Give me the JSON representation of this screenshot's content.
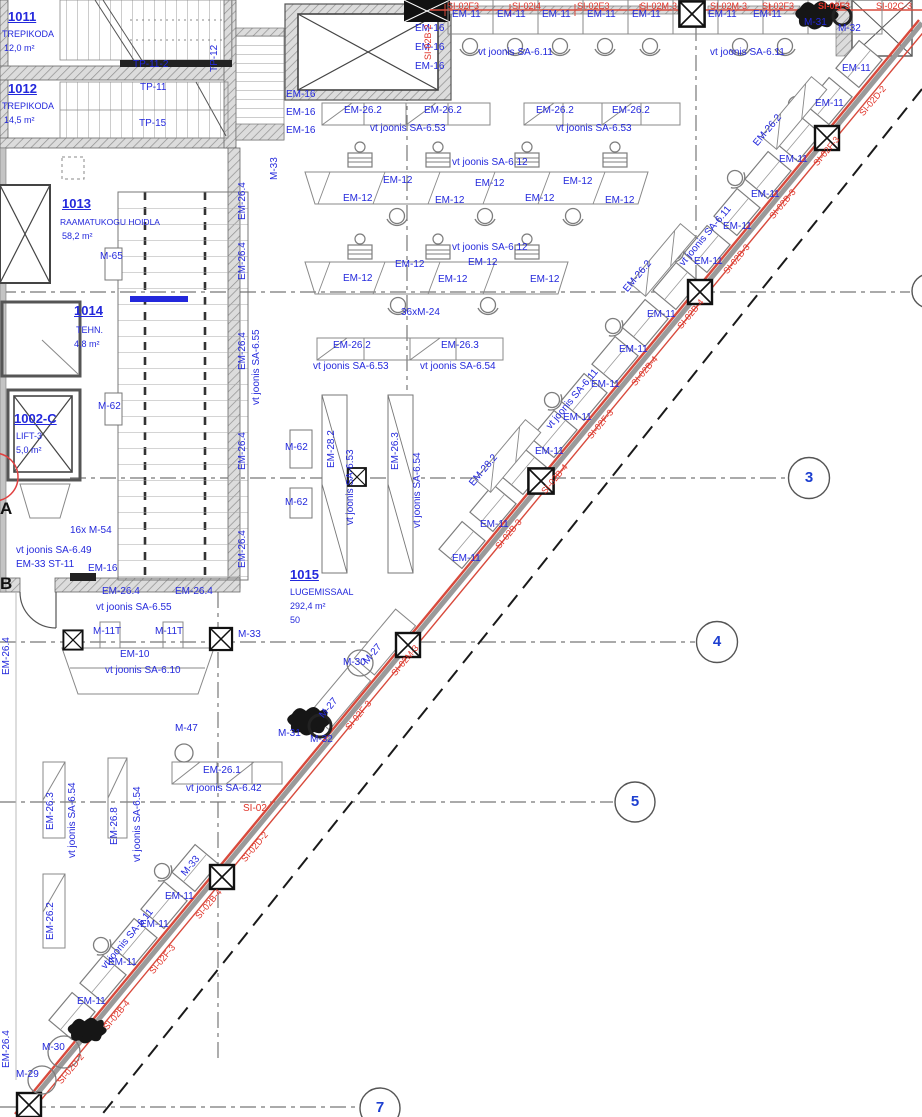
{
  "plan": {
    "colors": {
      "label_blue": "#2328dc",
      "label_red": "#e03328",
      "label_black": "#111111",
      "wall_red_line": "#d84a3c",
      "grid_gray": "#777777"
    },
    "grid_markers": [
      {
        "n": "3",
        "x": 809,
        "y": 478
      },
      {
        "n": "4",
        "x": 717,
        "y": 642
      },
      {
        "n": "5",
        "x": 635,
        "y": 802
      },
      {
        "n": "7",
        "x": 380,
        "y": 1108
      }
    ],
    "labels": [
      {
        "t": "1011",
        "x": 8,
        "y": 10,
        "s": 13,
        "b": 1,
        "u": 1
      },
      {
        "t": "TREPIKODA",
        "x": 2,
        "y": 30,
        "s": 9
      },
      {
        "t": "12,0 m²",
        "x": 4,
        "y": 44,
        "s": 9
      },
      {
        "t": "1012",
        "x": 8,
        "y": 82,
        "s": 13,
        "b": 1,
        "u": 1
      },
      {
        "t": "TREPIKODA",
        "x": 2,
        "y": 102,
        "s": 9
      },
      {
        "t": "14,5 m²",
        "x": 4,
        "y": 116,
        "s": 9
      },
      {
        "t": "1013",
        "x": 62,
        "y": 197,
        "s": 13,
        "b": 1,
        "u": 1
      },
      {
        "t": "RAAMATUKOGU HOIDLA",
        "x": 60,
        "y": 218,
        "s": 8.5
      },
      {
        "t": "58,2 m²",
        "x": 62,
        "y": 232,
        "s": 9
      },
      {
        "t": "1014",
        "x": 74,
        "y": 304,
        "s": 13,
        "b": 1,
        "u": 1
      },
      {
        "t": "TEHN.",
        "x": 76,
        "y": 326,
        "s": 9
      },
      {
        "t": "4,8 m²",
        "x": 74,
        "y": 340,
        "s": 9
      },
      {
        "t": "1002-C",
        "x": 14,
        "y": 412,
        "s": 13,
        "b": 1,
        "u": 1
      },
      {
        "t": "LIFT-3",
        "x": 16,
        "y": 432,
        "s": 9
      },
      {
        "t": "5,0 m²",
        "x": 16,
        "y": 446,
        "s": 9
      },
      {
        "t": "1015",
        "x": 290,
        "y": 568,
        "s": 13,
        "b": 1,
        "u": 1
      },
      {
        "t": "LUGEMISSAAL",
        "x": 290,
        "y": 588,
        "s": 9
      },
      {
        "t": "292,4 m²",
        "x": 290,
        "y": 602,
        "s": 9
      },
      {
        "t": "50",
        "x": 290,
        "y": 616,
        "s": 9
      },
      {
        "t": "TP-11-2",
        "x": 133,
        "y": 60
      },
      {
        "t": "TP-11",
        "x": 140,
        "y": 83
      },
      {
        "t": "TP-15",
        "x": 139,
        "y": 119
      },
      {
        "t": "TP-12",
        "x": 210,
        "y": 72,
        "r": -90
      },
      {
        "t": "M-33",
        "x": 270,
        "y": 180,
        "r": -90
      },
      {
        "t": "A",
        "x": 0,
        "y": 500,
        "c": "k",
        "s": 17,
        "b": 1
      },
      {
        "t": "B",
        "x": 0,
        "y": 575,
        "c": "k",
        "s": 17,
        "b": 1
      },
      {
        "t": "EM-16",
        "x": 415,
        "y": 24
      },
      {
        "t": "EM-16",
        "x": 415,
        "y": 43
      },
      {
        "t": "EM-16",
        "x": 415,
        "y": 62
      },
      {
        "t": "EM-16",
        "x": 286,
        "y": 90
      },
      {
        "t": "EM-16",
        "x": 286,
        "y": 108
      },
      {
        "t": "EM-16",
        "x": 286,
        "y": 126
      },
      {
        "t": "EM-11",
        "x": 452,
        "y": 10
      },
      {
        "t": "EM-11",
        "x": 497,
        "y": 10
      },
      {
        "t": "EM-11",
        "x": 542,
        "y": 10
      },
      {
        "t": "EM-11",
        "x": 587,
        "y": 10
      },
      {
        "t": "EM-11",
        "x": 632,
        "y": 10
      },
      {
        "t": "EM-11",
        "x": 708,
        "y": 10
      },
      {
        "t": "EM-11",
        "x": 753,
        "y": 10
      },
      {
        "t": "vt joonis SA-6.11",
        "x": 478,
        "y": 48
      },
      {
        "t": "vt joonis SA-6.11",
        "x": 710,
        "y": 48
      },
      {
        "t": "M-31",
        "x": 804,
        "y": 18
      },
      {
        "t": "M-32",
        "x": 838,
        "y": 24
      },
      {
        "t": "SI-02F3",
        "x": 447,
        "y": 2,
        "c": "r",
        "s": 9
      },
      {
        "t": "SI-02I4",
        "x": 512,
        "y": 2,
        "c": "r",
        "s": 9
      },
      {
        "t": "SI-02E3",
        "x": 577,
        "y": 2,
        "c": "r",
        "s": 9
      },
      {
        "t": "SI-02M-3",
        "x": 640,
        "y": 2,
        "c": "r",
        "s": 9
      },
      {
        "t": "SI-02M-3",
        "x": 710,
        "y": 2,
        "c": "r",
        "s": 9
      },
      {
        "t": "SI-02F3",
        "x": 762,
        "y": 2,
        "c": "r",
        "s": 9
      },
      {
        "t": "SI-02F3",
        "x": 818,
        "y": 2,
        "c": "r",
        "s": 9,
        "b": 1
      },
      {
        "t": "SI-02C-3",
        "x": 876,
        "y": 2,
        "c": "r",
        "s": 9
      },
      {
        "t": "SI-02B-2",
        "x": 424,
        "y": 60,
        "r": -90,
        "c": "r",
        "s": 9
      },
      {
        "t": "EM-26.2",
        "x": 344,
        "y": 106
      },
      {
        "t": "EM-26.2",
        "x": 424,
        "y": 106
      },
      {
        "t": "EM-26.2",
        "x": 536,
        "y": 106
      },
      {
        "t": "EM-26.2",
        "x": 612,
        "y": 106
      },
      {
        "t": "vt joonis SA-6.53",
        "x": 370,
        "y": 124
      },
      {
        "t": "vt joonis SA-6.53",
        "x": 556,
        "y": 124
      },
      {
        "t": "vt joonis SA-6.12",
        "x": 452,
        "y": 158
      },
      {
        "t": "EM-12",
        "x": 383,
        "y": 176
      },
      {
        "t": "EM-12",
        "x": 343,
        "y": 194
      },
      {
        "t": "EM-12",
        "x": 435,
        "y": 196
      },
      {
        "t": "EM-12",
        "x": 475,
        "y": 179
      },
      {
        "t": "EM-12",
        "x": 525,
        "y": 194
      },
      {
        "t": "EM-12",
        "x": 563,
        "y": 177
      },
      {
        "t": "EM-12",
        "x": 605,
        "y": 196
      },
      {
        "t": "vt joonis SA-6.12",
        "x": 452,
        "y": 243
      },
      {
        "t": "EM-12",
        "x": 395,
        "y": 260
      },
      {
        "t": "EM-12",
        "x": 343,
        "y": 274
      },
      {
        "t": "EM-12",
        "x": 438,
        "y": 275
      },
      {
        "t": "EM-12",
        "x": 468,
        "y": 258
      },
      {
        "t": "EM-12",
        "x": 530,
        "y": 275
      },
      {
        "t": "36xM-24",
        "x": 401,
        "y": 308
      },
      {
        "t": "EM-26.2",
        "x": 333,
        "y": 341
      },
      {
        "t": "EM-26.3",
        "x": 441,
        "y": 341
      },
      {
        "t": "vt joonis SA-6.53",
        "x": 313,
        "y": 362
      },
      {
        "t": "vt joonis SA-6.54",
        "x": 420,
        "y": 362
      },
      {
        "t": "M-65",
        "x": 100,
        "y": 252
      },
      {
        "t": "M-62",
        "x": 98,
        "y": 402
      },
      {
        "t": "M-62",
        "x": 285,
        "y": 443
      },
      {
        "t": "M-62",
        "x": 285,
        "y": 498
      },
      {
        "t": "EM-28.2",
        "x": 327,
        "y": 468,
        "r": -90
      },
      {
        "t": "vt joonis SA-6.53",
        "x": 346,
        "y": 525,
        "r": -90
      },
      {
        "t": "EM-26.3",
        "x": 391,
        "y": 470,
        "r": -90
      },
      {
        "t": "vt joonis SA-6.54",
        "x": 413,
        "y": 528,
        "r": -90
      },
      {
        "t": "EM-26.4",
        "x": 238,
        "y": 220,
        "r": -90
      },
      {
        "t": "EM-26.4",
        "x": 238,
        "y": 280,
        "r": -90
      },
      {
        "t": "EM-26.4",
        "x": 238,
        "y": 370,
        "r": -90
      },
      {
        "t": "EM-26.4",
        "x": 238,
        "y": 470,
        "r": -90
      },
      {
        "t": "EM-26.4",
        "x": 238,
        "y": 568,
        "r": -90
      },
      {
        "t": "vt joonis SA-6.55",
        "x": 252,
        "y": 405,
        "r": -90
      },
      {
        "t": "16x M-54",
        "x": 70,
        "y": 526
      },
      {
        "t": "vt joonis SA-6.49",
        "x": 16,
        "y": 546
      },
      {
        "t": "EM-33 ST-11",
        "x": 16,
        "y": 560
      },
      {
        "t": "EM-16",
        "x": 88,
        "y": 564
      },
      {
        "t": "EM-26.4",
        "x": 102,
        "y": 587
      },
      {
        "t": "EM-26.4",
        "x": 175,
        "y": 587
      },
      {
        "t": "vt joonis SA-6.55",
        "x": 96,
        "y": 603
      },
      {
        "t": "M-11T",
        "x": 93,
        "y": 627
      },
      {
        "t": "M-11T",
        "x": 155,
        "y": 627
      },
      {
        "t": "M-33",
        "x": 238,
        "y": 630
      },
      {
        "t": "EM-10",
        "x": 120,
        "y": 650
      },
      {
        "t": "vt joonis SA-6.10",
        "x": 105,
        "y": 666
      },
      {
        "t": "M-27",
        "x": 362,
        "y": 660,
        "r": -50
      },
      {
        "t": "M-27",
        "x": 318,
        "y": 714,
        "r": -50
      },
      {
        "t": "M-30",
        "x": 343,
        "y": 658
      },
      {
        "t": "M-31",
        "x": 278,
        "y": 729
      },
      {
        "t": "M-32",
        "x": 310,
        "y": 735
      },
      {
        "t": "M-47",
        "x": 175,
        "y": 724
      },
      {
        "t": "EM-26.1",
        "x": 203,
        "y": 766
      },
      {
        "t": "vt joonis SA-6.42",
        "x": 186,
        "y": 784
      },
      {
        "t": "SI-02",
        "x": 243,
        "y": 804,
        "c": "r"
      },
      {
        "t": "EM-26.3",
        "x": 46,
        "y": 830,
        "r": -90
      },
      {
        "t": "vt joonis SA-6.54",
        "x": 68,
        "y": 858,
        "r": -90
      },
      {
        "t": "EM-26.8",
        "x": 110,
        "y": 845,
        "r": -90
      },
      {
        "t": "vt joonis SA-6.54",
        "x": 133,
        "y": 862,
        "r": -90
      },
      {
        "t": "EM-26.2",
        "x": 46,
        "y": 940,
        "r": -90
      },
      {
        "t": "EM-26.4",
        "x": 2,
        "y": 675,
        "r": -90
      },
      {
        "t": "EM-26.4",
        "x": 2,
        "y": 1068,
        "r": -90
      },
      {
        "t": "M-33",
        "x": 180,
        "y": 872,
        "r": -50
      },
      {
        "t": "EM-11",
        "x": 842,
        "y": 64
      },
      {
        "t": "EM-11",
        "x": 815,
        "y": 99
      },
      {
        "t": "EM-11",
        "x": 779,
        "y": 155
      },
      {
        "t": "EM-11",
        "x": 751,
        "y": 190
      },
      {
        "t": "EM-11",
        "x": 723,
        "y": 222
      },
      {
        "t": "EM-11",
        "x": 694,
        "y": 257
      },
      {
        "t": "EM-11",
        "x": 647,
        "y": 310
      },
      {
        "t": "EM-11",
        "x": 619,
        "y": 345
      },
      {
        "t": "EM-11",
        "x": 591,
        "y": 380
      },
      {
        "t": "EM-11",
        "x": 563,
        "y": 413
      },
      {
        "t": "EM-11",
        "x": 535,
        "y": 447
      },
      {
        "t": "EM-11",
        "x": 480,
        "y": 520
      },
      {
        "t": "EM-11",
        "x": 452,
        "y": 554
      },
      {
        "t": "EM-11",
        "x": 165,
        "y": 892
      },
      {
        "t": "EM-11",
        "x": 140,
        "y": 920
      },
      {
        "t": "EM-11",
        "x": 108,
        "y": 958
      },
      {
        "t": "EM-11",
        "x": 77,
        "y": 997
      },
      {
        "t": "vt joonis SA-6.11",
        "x": 678,
        "y": 262,
        "r": -50
      },
      {
        "t": "vt joonis SA-6.11",
        "x": 545,
        "y": 425,
        "r": -50
      },
      {
        "t": "vt joonis SA-6.11",
        "x": 100,
        "y": 965,
        "r": -50
      },
      {
        "t": "EM-26.2",
        "x": 752,
        "y": 142,
        "r": -50
      },
      {
        "t": "EM-26.2",
        "x": 622,
        "y": 288,
        "r": -50
      },
      {
        "t": "EM-28.2",
        "x": 468,
        "y": 482,
        "r": -50
      },
      {
        "t": "M-30",
        "x": 42,
        "y": 1043
      },
      {
        "t": "M-29",
        "x": 16,
        "y": 1070
      },
      {
        "t": "SI-02D-2",
        "x": 858,
        "y": 112,
        "r": -50,
        "c": "r",
        "s": 9
      },
      {
        "t": "SI-02F-3",
        "x": 812,
        "y": 162,
        "r": -50,
        "c": "r",
        "s": 9
      },
      {
        "t": "SI-02B-3",
        "x": 768,
        "y": 215,
        "r": -50,
        "c": "r",
        "s": 9
      },
      {
        "t": "SI-02B-3",
        "x": 722,
        "y": 270,
        "r": -50,
        "c": "r",
        "s": 9
      },
      {
        "t": "SI-02B-4",
        "x": 676,
        "y": 325,
        "r": -50,
        "c": "r",
        "s": 9
      },
      {
        "t": "SI-02B-4",
        "x": 630,
        "y": 382,
        "r": -50,
        "c": "r",
        "s": 9
      },
      {
        "t": "SI-02F-3",
        "x": 586,
        "y": 435,
        "r": -50,
        "c": "r",
        "s": 9
      },
      {
        "t": "SI-02B-4",
        "x": 540,
        "y": 490,
        "r": -50,
        "c": "r",
        "s": 9
      },
      {
        "t": "SI-02B-3",
        "x": 494,
        "y": 545,
        "r": -50,
        "c": "r",
        "s": 9
      },
      {
        "t": "SI-02M-3",
        "x": 390,
        "y": 672,
        "r": -50,
        "c": "r",
        "s": 9
      },
      {
        "t": "SI-02F-3",
        "x": 344,
        "y": 726,
        "r": -50,
        "c": "r",
        "s": 9
      },
      {
        "t": "SI-02D-2",
        "x": 240,
        "y": 858,
        "r": -50,
        "c": "r",
        "s": 9
      },
      {
        "t": "SI-02B-4",
        "x": 194,
        "y": 915,
        "r": -50,
        "c": "r",
        "s": 9
      },
      {
        "t": "SI-02F-3",
        "x": 148,
        "y": 970,
        "r": -50,
        "c": "r",
        "s": 9
      },
      {
        "t": "SI-02B-4",
        "x": 102,
        "y": 1026,
        "r": -50,
        "c": "r",
        "s": 9
      },
      {
        "t": "SI-02D-2",
        "x": 56,
        "y": 1080,
        "r": -50,
        "c": "r",
        "s": 9
      }
    ]
  }
}
